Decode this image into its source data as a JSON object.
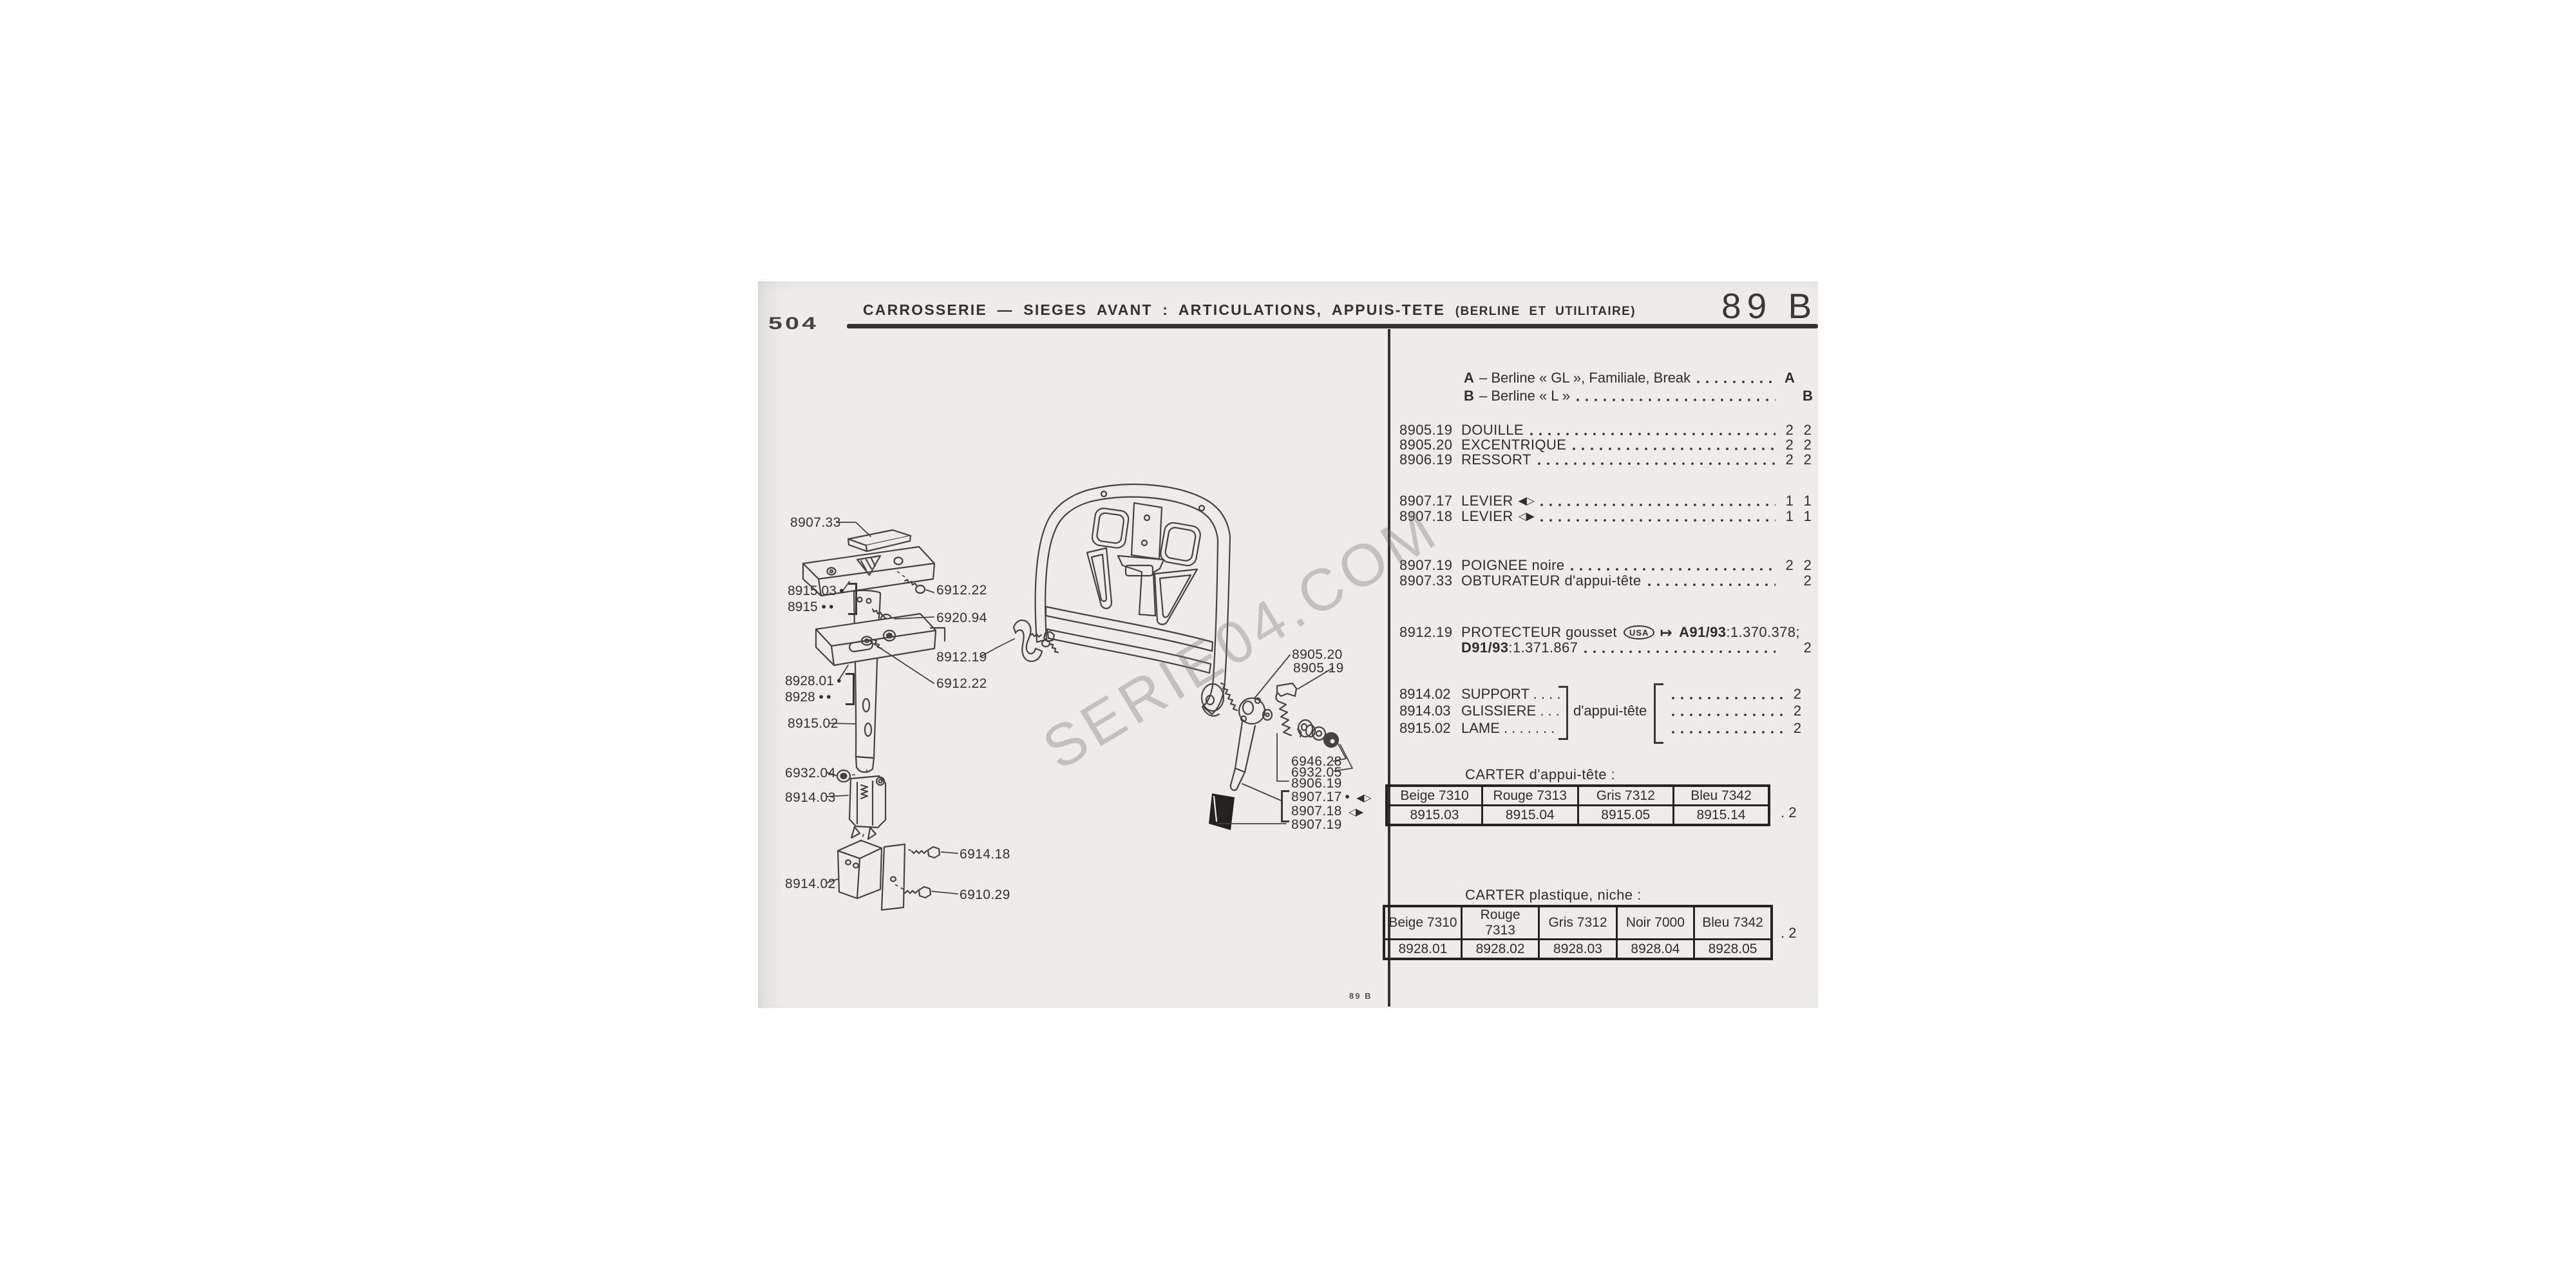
{
  "page": {
    "model_badge": "504",
    "page_code": "89 B",
    "title_lead": "CARROSSERIE",
    "title_rest": "— SIEGES AVANT : ARTICULATIONS, APPUIS-TETE",
    "title_paren": "(BERLINE ET UTILITAIRE)",
    "footer_code": "89 B",
    "watermark": "SERIE04.COM",
    "colors": {
      "paper": "#edece8",
      "ink": "#2f2d2a"
    }
  },
  "legend": {
    "rows": [
      {
        "code": "A",
        "label": "– Berline « GL », Familiale, Break",
        "value": "A"
      },
      {
        "code": "B",
        "label": "– Berline « L »",
        "value": "B"
      }
    ]
  },
  "parts": [
    {
      "ref": "8905.19",
      "label": "DOUILLE",
      "qty_a": "2",
      "qty_b": "2"
    },
    {
      "ref": "8905.20",
      "label": "EXCENTRIQUE",
      "qty_a": "2",
      "qty_b": "2"
    },
    {
      "ref": "8906.19",
      "label": "RESSORT",
      "qty_a": "2",
      "qty_b": "2"
    },
    {
      "ref": "8907.17",
      "label": "LEVIER",
      "icon": "◀▷",
      "qty_a": "1",
      "qty_b": "1"
    },
    {
      "ref": "8907.18",
      "label": "LEVIER",
      "icon": "◁▶",
      "qty_a": "1",
      "qty_b": "1"
    },
    {
      "ref": "8907.19",
      "label": "POIGNEE noire",
      "qty_a": "2",
      "qty_b": "2"
    },
    {
      "ref": "8907.33",
      "label": "OBTURATEUR d'appui-tête",
      "qty_a": "",
      "qty_b": "2"
    }
  ],
  "protecteur": {
    "ref": "8912.19",
    "label": "PROTECTEUR gousset",
    "badge": "USA",
    "arrow": "↦",
    "a_bold": "A91/93",
    "a_rest": ":1.370.378;",
    "d_bold": "D91/93",
    "d_rest": ":1.371.867",
    "qty_b": "2"
  },
  "group": {
    "shared_label": "d'appui-tête",
    "rows": [
      {
        "ref": "8914.02",
        "label": "SUPPORT . . . .",
        "qty": "2"
      },
      {
        "ref": "8914.03",
        "label": "GLISSIERE . . .",
        "qty": "2"
      },
      {
        "ref": "8915.02",
        "label": "LAME . . . . . . .",
        "qty": "2"
      }
    ]
  },
  "tables": [
    {
      "title": "CARTER d'appui-tête :",
      "headers": [
        "Beige 7310",
        "Rouge 7313",
        "Gris 7312",
        "Bleu 7342"
      ],
      "row": [
        "8915.03",
        "8915.04",
        "8915.05",
        "8915.14"
      ],
      "qty": ". 2"
    },
    {
      "title": "CARTER plastique, niche :",
      "headers": [
        "Beige 7310",
        "Rouge 7313",
        "Gris 7312",
        "Noir 7000",
        "Bleu 7342"
      ],
      "row": [
        "8928.01",
        "8928.02",
        "8928.03",
        "8928.04",
        "8928.05"
      ],
      "qty": ". 2"
    }
  ],
  "callouts": [
    {
      "text": "8907.33"
    },
    {
      "text": "6912.22"
    },
    {
      "text": "6920.94"
    },
    {
      "text": "8912.19"
    },
    {
      "text": "6912.22"
    },
    {
      "text": "8915.02"
    },
    {
      "text": "6932.04"
    },
    {
      "text": "8914.03"
    },
    {
      "text": "8914.02"
    },
    {
      "text": "6914.18"
    },
    {
      "text": "6910.29"
    },
    {
      "text": "8905.20"
    },
    {
      "text": "8905.19"
    },
    {
      "text": "6946.28"
    },
    {
      "text": "6932.05"
    },
    {
      "text": "8906.19"
    },
    {
      "text": "8907.17 •",
      "icon": "◀▷"
    },
    {
      "text": "8907.18",
      "icon": "◁▶"
    },
    {
      "text": "8907.19"
    }
  ],
  "callout_groups": [
    {
      "line1": "8915.03 •",
      "line2": "8915 • •"
    },
    {
      "line1": "8928.01 •",
      "line2": "8928 • •"
    }
  ]
}
